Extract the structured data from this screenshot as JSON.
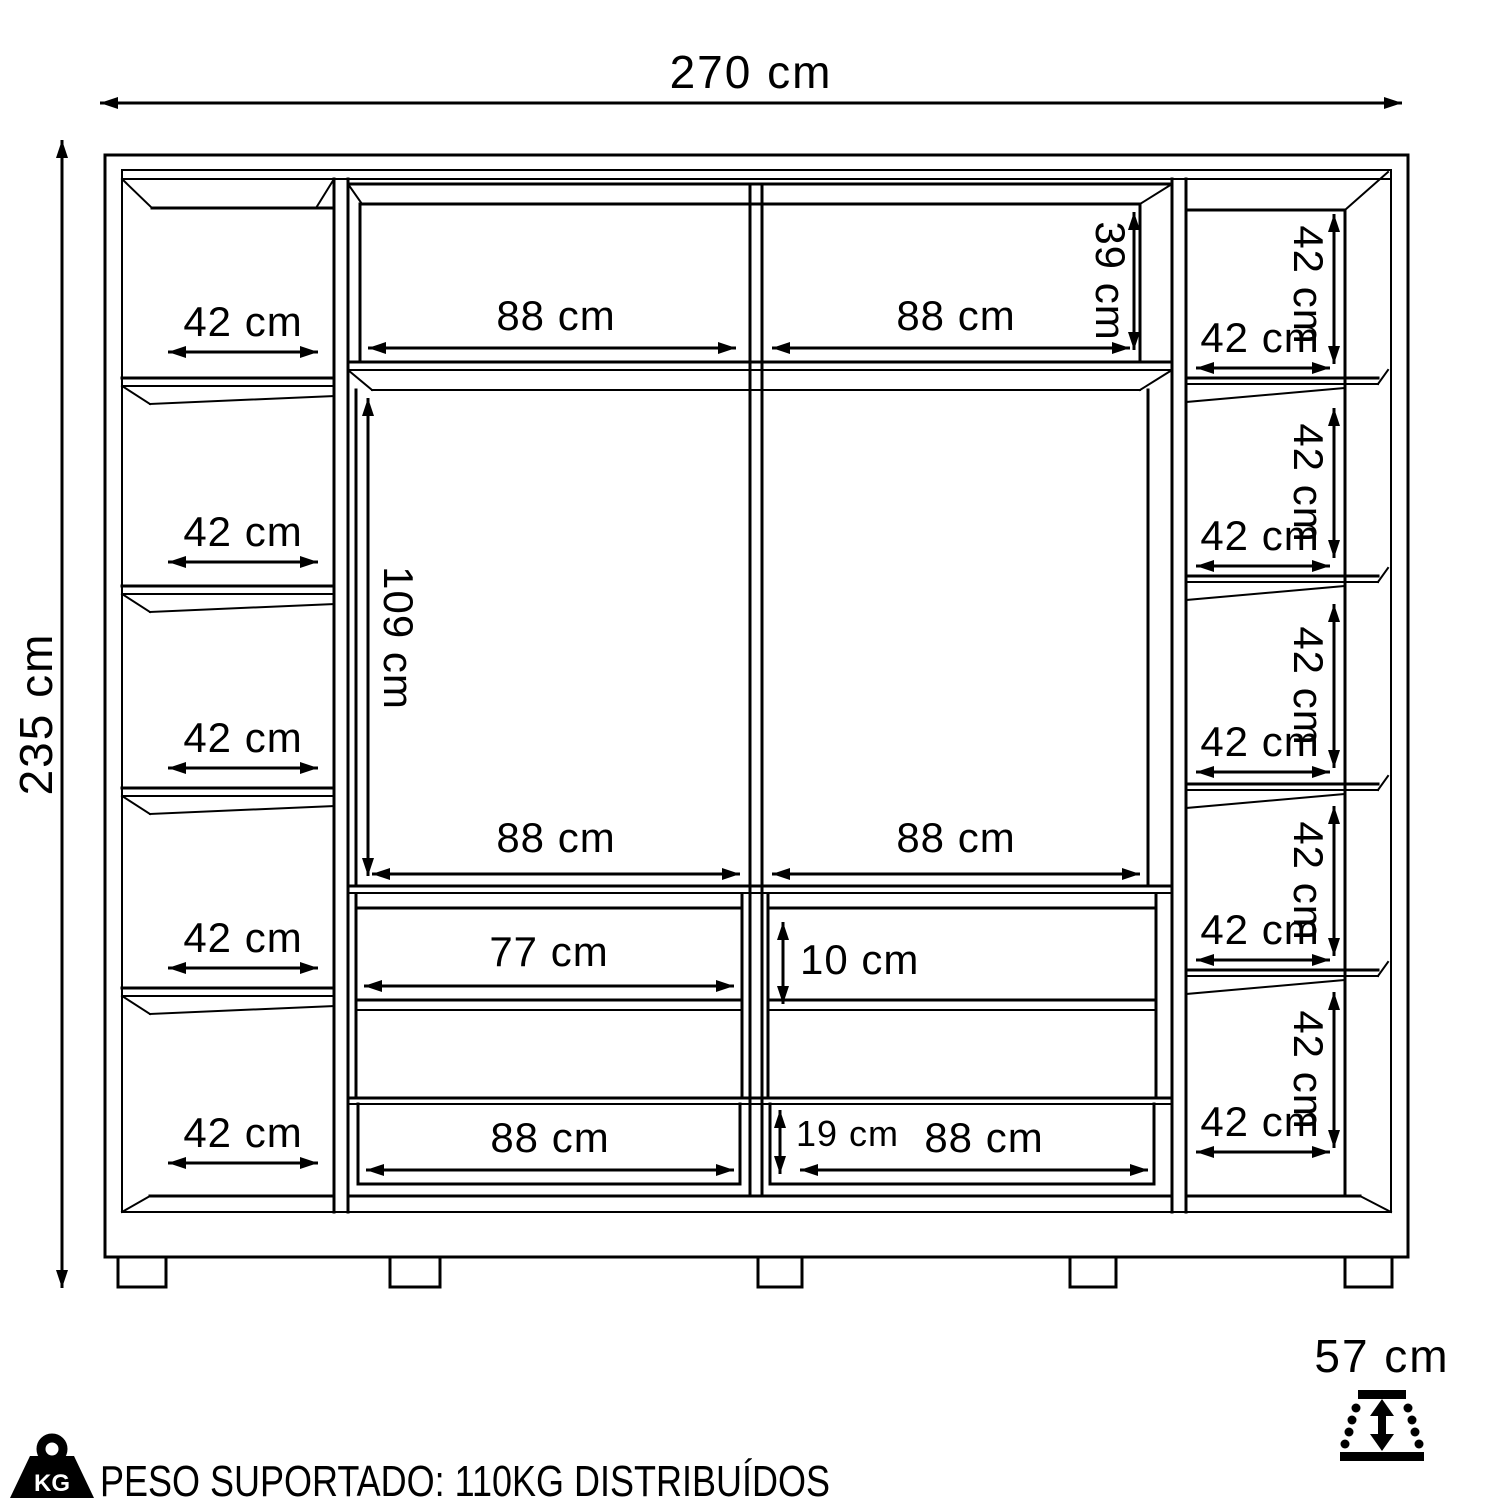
{
  "colors": {
    "ink": "#000000",
    "bg": "#ffffff"
  },
  "overall": {
    "width_label": "270 cm",
    "height_label": "235 cm",
    "depth_label": "57 cm"
  },
  "left_column": {
    "cells": [
      {
        "width_label": "42 cm"
      },
      {
        "width_label": "42 cm"
      },
      {
        "width_label": "42 cm"
      },
      {
        "width_label": "42 cm"
      },
      {
        "width_label": "42 cm"
      }
    ]
  },
  "right_column": {
    "cells": [
      {
        "height_label": "42 cm",
        "width_label": "42 cm"
      },
      {
        "height_label": "42 cm",
        "width_label": "42 cm"
      },
      {
        "height_label": "42 cm",
        "width_label": "42 cm"
      },
      {
        "height_label": "42 cm",
        "width_label": "42 cm"
      },
      {
        "height_label": "42 cm",
        "width_label": "42 cm"
      }
    ]
  },
  "middle": {
    "top_row": {
      "left_width_label": "88 cm",
      "right_width_label": "88 cm",
      "height_label": "39 cm"
    },
    "main_row": {
      "height_label": "109 cm",
      "left_width_label": "88 cm",
      "right_width_label": "88 cm"
    },
    "drawer_row": {
      "width_label": "77 cm",
      "front_height_label": "10 cm"
    },
    "bottom_row": {
      "left_width_label": "88 cm",
      "gap_height_label": "19 cm",
      "right_width_label": "88 cm"
    }
  },
  "footer": {
    "kg_badge_label": "KG",
    "weight_note": "PESO SUPORTADO: 110KG DISTRIBUÍDOS"
  }
}
